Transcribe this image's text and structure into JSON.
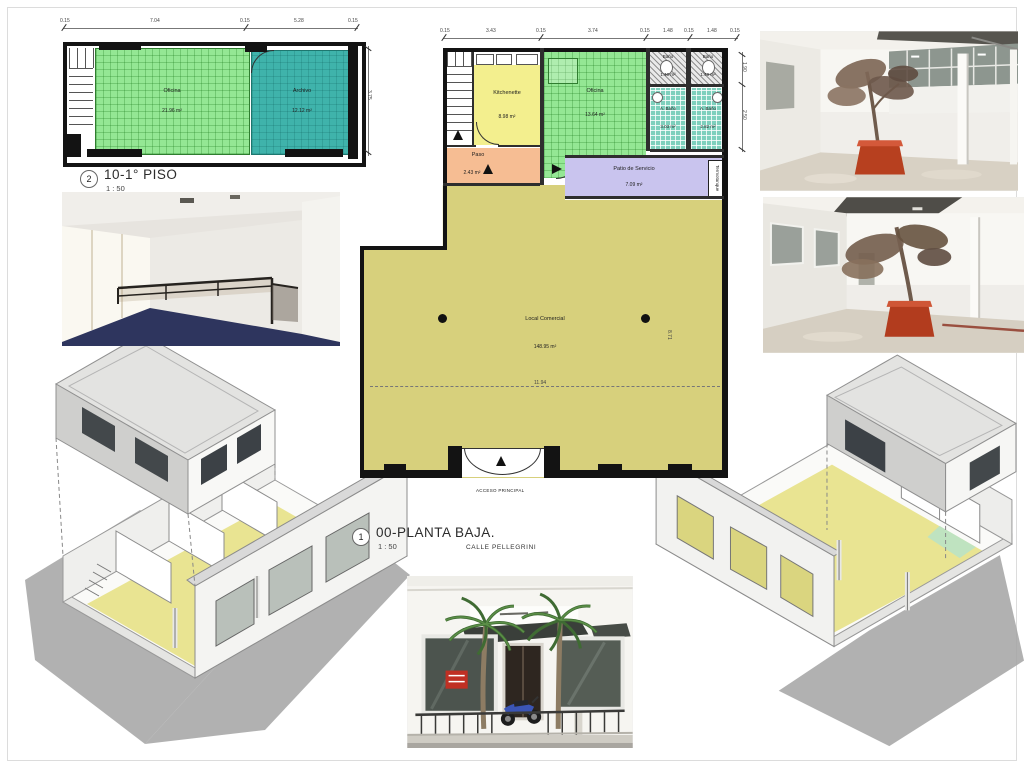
{
  "plan_first": {
    "ref": "2",
    "title": "10-1° PISO",
    "scale": "1 : 50",
    "dims_top": [
      "0.15",
      "7.04",
      "0.15",
      "5.28",
      "0.15"
    ],
    "dim_right": "3.75",
    "rooms": {
      "oficina": {
        "name": "Oficina",
        "area": "21.96 m²"
      },
      "archivo": {
        "name": "Archivo",
        "area": "12.12 m²"
      }
    }
  },
  "plan_ground": {
    "ref": "1",
    "title": "00-PLANTA BAJA.",
    "scale": "1 : 50",
    "street_label": "CALLE PELLEGRINI",
    "access_label": "ACCESO PRINCIPAL",
    "dims_top": [
      "0.15",
      "3.43",
      "0.15",
      "3.74",
      "0.15",
      "1.48",
      "0.15",
      "1.48",
      "0.15"
    ],
    "dims_right": [
      "1.90",
      "2.50"
    ],
    "dim_width": "11.94",
    "dim_height": "8.71",
    "rooms": {
      "kitchenette": {
        "name": "Kitchenette",
        "area": "8.98 m²"
      },
      "oficina": {
        "name": "Oficina",
        "area": "13.64 m²"
      },
      "paso": {
        "name": "Paso",
        "area": "2.43 m²"
      },
      "bano_a": {
        "name": "Baño",
        "area": "1.40 m²"
      },
      "bano_b": {
        "name": "Baño",
        "area": "1.40 m²"
      },
      "antebano_a": {
        "name": "A. Baño",
        "area": "3.03 m²"
      },
      "antebano_b": {
        "name": "A. Baño",
        "area": "2.82 m²"
      },
      "patio": {
        "name": "Patio de Servicio",
        "area": "7.09 m²"
      },
      "local": {
        "name": "Local Comercial",
        "area": "148.95 m²"
      }
    },
    "termotanque_label": "Termotanque"
  },
  "colors": {
    "room_green": "#94e794",
    "room_teal": "#3fb3ab",
    "room_yellow": "#f3ef8e",
    "room_salmon": "#f6bd93",
    "room_lavender": "#c9c4ee",
    "room_olive": "#d7d07c",
    "bath_teal": "#7ed0bd",
    "wall": "#131313",
    "planter_orange": "#bf4527"
  }
}
